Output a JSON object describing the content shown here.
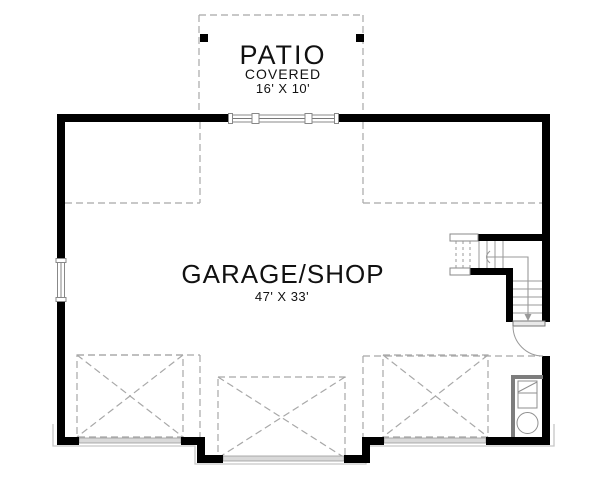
{
  "labels": {
    "patio": {
      "name": "PATIO",
      "type": "COVERED",
      "size": "16' X 10'"
    },
    "garage": {
      "name": "GARAGE/SHOP",
      "size": "47' X 33'"
    }
  },
  "colors": {
    "wall": "#000000",
    "dash": "#a8a8a8",
    "stair_line": "#999999",
    "fixture_line": "#7d7d7d",
    "threshold_fill": "#d9d9d9",
    "trim": "#c6c6c6",
    "text": "#111111",
    "background": "#ffffff"
  }
}
